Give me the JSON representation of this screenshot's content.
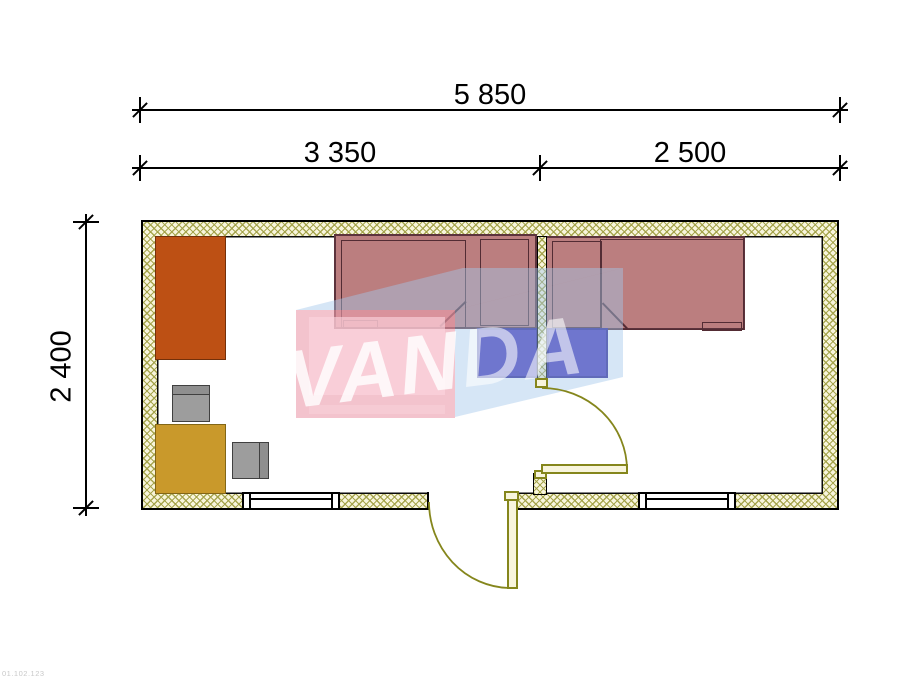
{
  "dimensions": {
    "total_width": "5 850",
    "left_section_width": "3 350",
    "right_section_width": "2 500",
    "depth": "2 400"
  },
  "watermark": {
    "brand_left": "VAN",
    "brand_right": "DA"
  },
  "corner_code": "01.102.123",
  "plan": {
    "rooms": [
      "left-room",
      "right-room"
    ],
    "furniture": [
      "wardrobe",
      "chair",
      "table",
      "chair",
      "single-bed",
      "single-bed",
      "nightstand",
      "nightstand"
    ],
    "openings": [
      "window-left-room",
      "window-right-room",
      "entrance-door",
      "interior-door"
    ]
  },
  "colors": {
    "wall_hatch": "#a3a248",
    "wall_fill": "#f8f5dc",
    "door_olive": "#85861c",
    "bed_fill": "#bb7e7f",
    "bed_outline": "#5c333c",
    "wardrobe": "#bd5014",
    "table": "#c9992b",
    "chair": "#9d9d9d",
    "nightstand": "#4433b6",
    "watermark_pink": "#ec9eaf",
    "watermark_light_blue": "#a5c8eb"
  }
}
